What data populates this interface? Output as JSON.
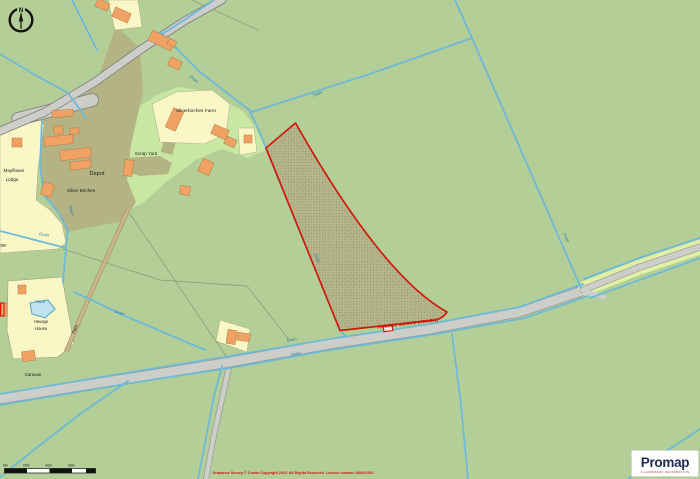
{
  "map": {
    "labels": {
      "silverbirches_farm": "Silverbirches Farm",
      "scrap_yard": "Scrap Yard",
      "depot": "Depot",
      "silver_birches": "Silver Birches",
      "mayflower_1": "Mayflower",
      "mayflower_2": "Lodge",
      "lane_fragment": "ne",
      "pond": "Pond",
      "havage_1": "Havage",
      "havage_2": "House",
      "track": "Track",
      "caravan": "Caravan",
      "plot_label": "HAVAGE GROVE (TRACK)",
      "drain": "Drain"
    },
    "compass": {
      "north": "N"
    }
  },
  "scale_bar": {
    "labels": [
      "0m",
      "20m",
      "40m",
      "60m"
    ]
  },
  "attribution": "Ordnance Survey © Crown Copyright 2022. All Rights Reserved. Licence number 100022432",
  "logo": {
    "name": "Promap",
    "tagline": "A LANDMARK INFORMATION"
  },
  "colors": {
    "field_green": "#b3cf97",
    "bright_green": "#c8e7a2",
    "olive_yard": "#b4b383",
    "cream_property": "#fbf6c6",
    "building_orange": "#efa263",
    "road_gray": "#cdcdc9",
    "verge_green": "#e0f0a4",
    "drain_blue": "#6fb9d8",
    "pond_blue": "#bfe3f3",
    "plot_outline_red": "#d1180c",
    "water_label_blue": "#2d7ca6",
    "attribution_red": "#cc1111",
    "logo_navy": "#1b2b52"
  }
}
